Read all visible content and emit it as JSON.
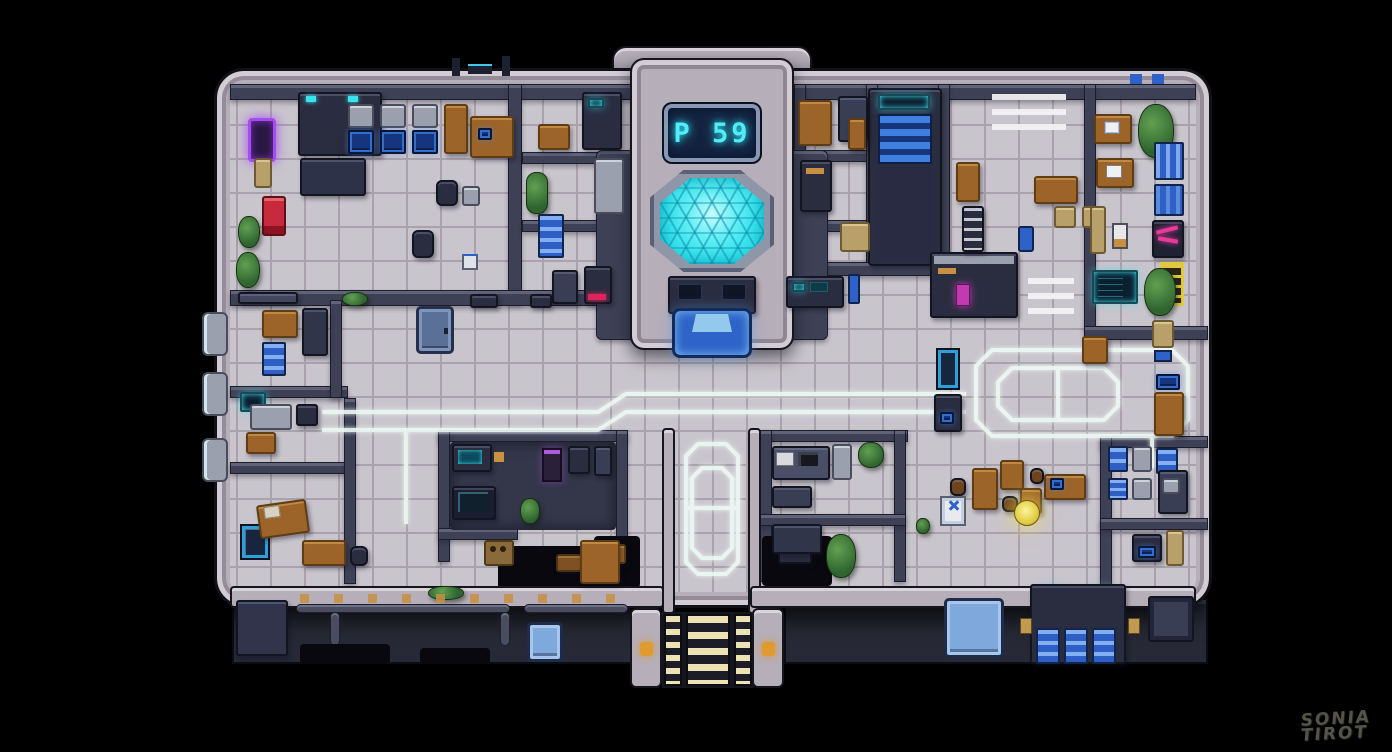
{
  "scene": {
    "description": "pixel-art top-down map of a sci-fi facility interior on black background",
    "background": "#000000"
  },
  "chamber": {
    "display_text": "P 59"
  },
  "signature": {
    "line1": "SONIA",
    "line2": "TIROT"
  },
  "palette": {
    "bg": "#000000",
    "hull": "#b6aeb8",
    "wall": "#3e4156",
    "darkbox": "#2a2d40",
    "floor": "#c9c5cc",
    "grout": "#a9a1ab",
    "cyan": "#3ae4ee",
    "digits": "#52ecf6",
    "stairsblue": "#3f7fe0",
    "stairsblue2": "#16367c",
    "holo": "#2e63c8",
    "cream": "#ece2b4",
    "purple": "#a44cf0",
    "red": "#c62a3c",
    "wood": "#9c6428",
    "green": "#2f6330",
    "locker": "#2d5fc4",
    "pink": "#e83a9a",
    "yellow": "#e0c93e",
    "amber": "#c89040",
    "tan": "#b9a06a",
    "glow": "#edf8f4"
  }
}
